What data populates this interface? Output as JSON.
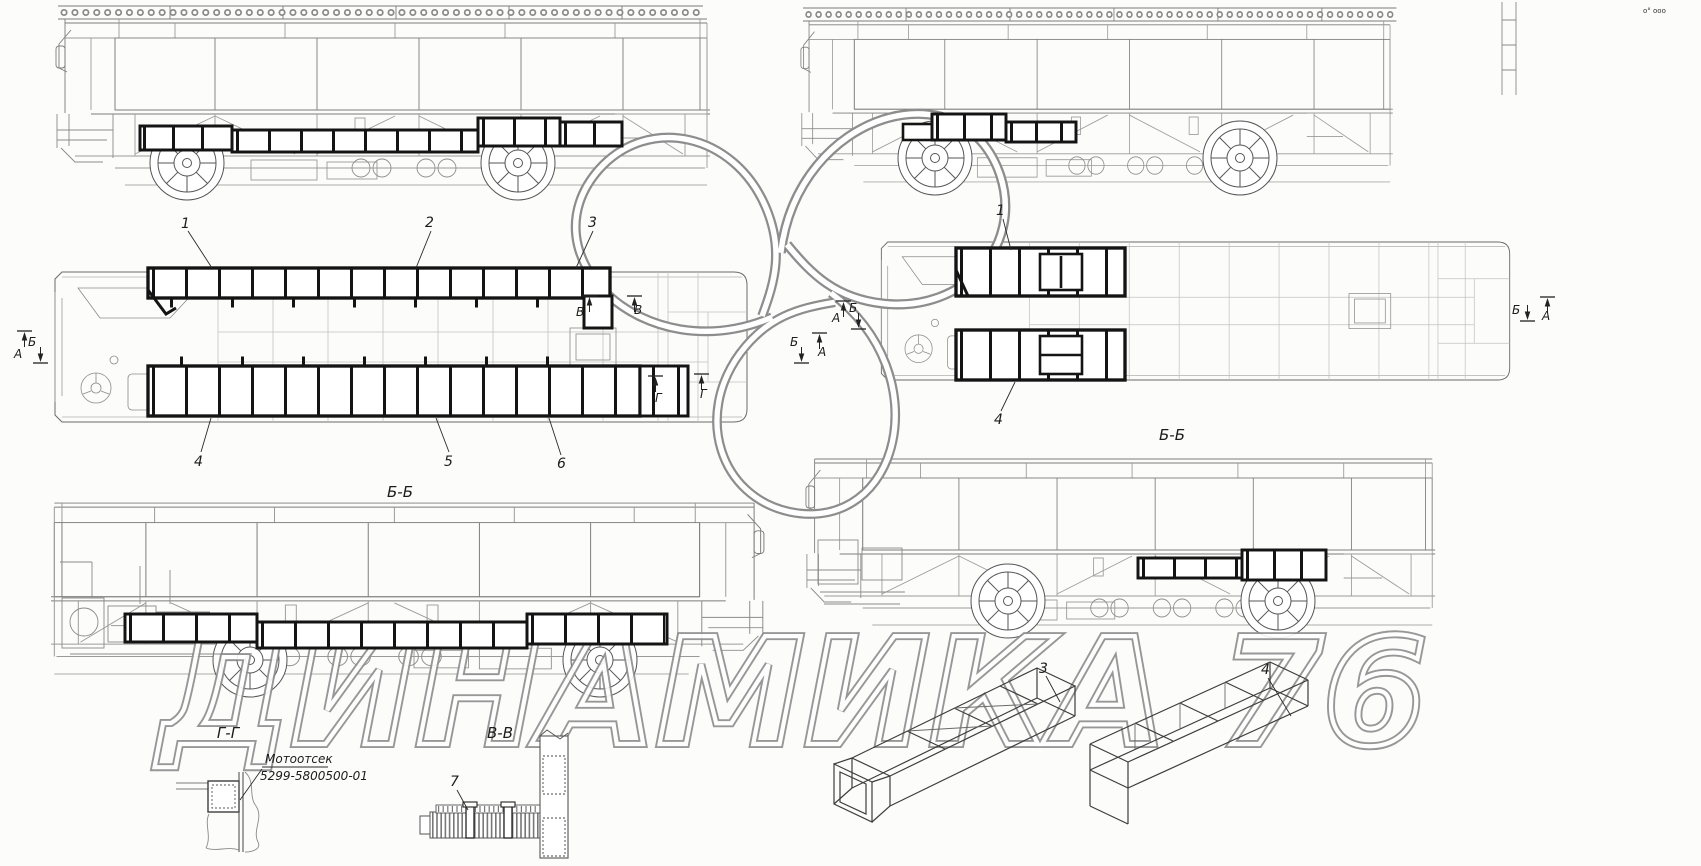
{
  "labels": {
    "section_bb": "Б-Б",
    "section_gg": "Г-Г",
    "section_vv": "В-В",
    "letter_a": "А",
    "letter_b": "Б",
    "letter_v": "В",
    "letter_g": "Г"
  },
  "callouts": {
    "n1": "1",
    "n2": "2",
    "n3": "3",
    "n4": "4",
    "n5": "5",
    "n6": "6",
    "n7": "7"
  },
  "note": {
    "line1": "Мотоотсек",
    "line2": "5299-5800500-01"
  },
  "watermark": "ДИНАМИКА 76",
  "corner_mark": "о° ооо"
}
